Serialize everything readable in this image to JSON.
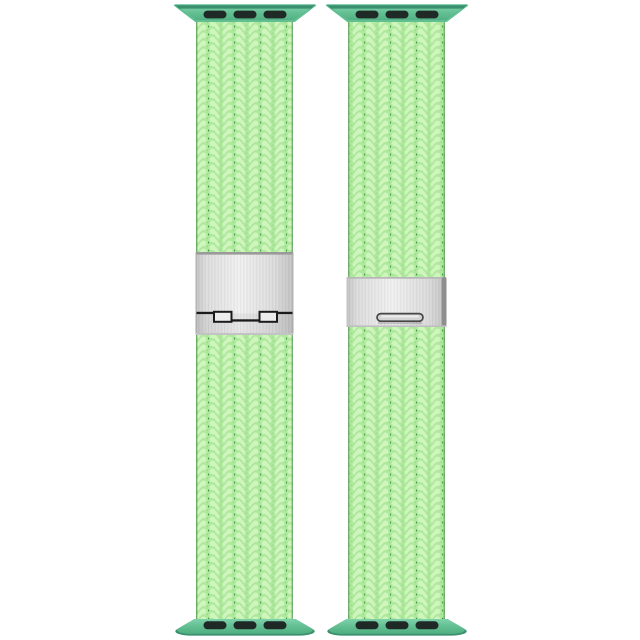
{
  "scene": {
    "background": "#ffffff",
    "item_count": 2,
    "description": "Bright green braided watch band shown twice: left strap from the back with fold-over clasp hinge, right strap from the front with release slot buckle"
  },
  "colors": {
    "background": "#ffffff",
    "braid_light": "#aee89d",
    "braid_highlight": "#cef5bc",
    "braid_gap": "#2e8a37",
    "braid_edge": "#256d2c",
    "lug_teal_light": "#7fd2ab",
    "lug_teal": "#62bf92",
    "lug_teal_dark": "#3a8f6e",
    "lug_slot": "#1f2a26",
    "silver_light": "#f1f1f1",
    "silver": "#dcdcdc",
    "silver_dark": "#c3c3c3",
    "silver_edge": "#9a9a9a",
    "hinge_dark": "#1b1b1b",
    "buckle_shadow": "#8f8f8f"
  },
  "bands": [
    {
      "id": "band-back-view",
      "position": "left",
      "view": "back",
      "hardware": [
        "lug-adapter-top",
        "fold-over-clasp-back",
        "lug-adapter-bottom"
      ]
    },
    {
      "id": "band-front-view",
      "position": "right",
      "view": "front",
      "hardware": [
        "lug-adapter-top",
        "clasp-front-slot",
        "lug-adapter-bottom"
      ]
    }
  ]
}
